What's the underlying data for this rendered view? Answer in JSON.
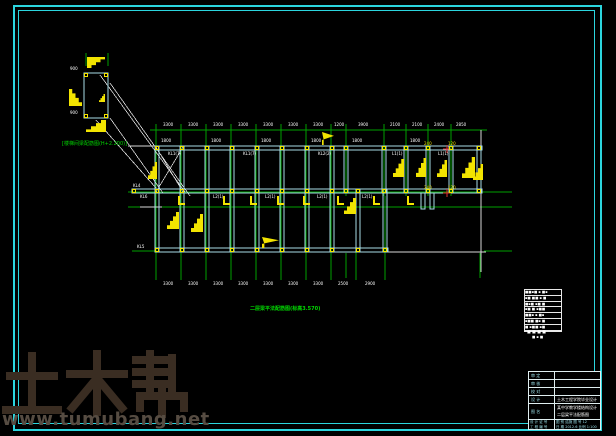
{
  "colors": {
    "background": "#000000",
    "frame": "#2bd5de",
    "grid": "#00a000",
    "beam": "#a9dde6",
    "symbol_yellow": "#f2e400",
    "line_white": "#d8d8d8",
    "accent_red": "#e03030",
    "label_green": "#00d800",
    "watermark_logo": "#3a2d22",
    "watermark_url": "#564c42"
  },
  "watermark": {
    "logo": "土木帮",
    "url": "www.tumubang.net"
  },
  "labels": {
    "detail_note": "[楼梯间梁配筋图(H+2.200)]",
    "plan_title": "二层梁平法配筋图(标高3.570)"
  },
  "legend": {
    "rows": [
      "■■▪■ ▪ ■▪",
      "▪■ ■■ ▪ ■",
      "■▪■ ▪■ ■",
      "▪■ ■ ▪■■",
      "■■▪ ▪ ■▪",
      "▪■■ ■▪ ■",
      "■ ▪■■ ▪■"
    ],
    "caption": "■ ■ ■ ■",
    "scale": "■ ▪ ■"
  },
  "title_block": {
    "rows": [
      {
        "label": "审 定",
        "value": ""
      },
      {
        "label": "审 核",
        "value": ""
      },
      {
        "label": "校 对",
        "value": ""
      },
      {
        "label": "设 计",
        "value": "土木工程学院毕业设计"
      },
      {
        "label": "图 名",
        "value": "某中学教学楼结构设计",
        "value2": "二层梁平法配筋图"
      }
    ],
    "footer": [
      {
        "left": "设 计 证 号",
        "right": "图 别  结施  图 号  12"
      },
      {
        "left": "工 程 编 号",
        "right": "日 期 2012.6  比例 1:100"
      }
    ]
  },
  "drawing": {
    "grid_vlines": [
      [
        156,
        124,
        280
      ],
      [
        181,
        124,
        280
      ],
      [
        206,
        124,
        280
      ],
      [
        231,
        124,
        280
      ],
      [
        256,
        124,
        280
      ],
      [
        281,
        124,
        280
      ],
      [
        306,
        124,
        280
      ],
      [
        331,
        124,
        280
      ],
      [
        346,
        124,
        196
      ],
      [
        384,
        124,
        196
      ],
      [
        406,
        124,
        196
      ],
      [
        428,
        124,
        196
      ],
      [
        451,
        124,
        196
      ],
      [
        356,
        196,
        280
      ],
      [
        385,
        196,
        280
      ],
      [
        346,
        253,
        278
      ],
      [
        480,
        253,
        278
      ],
      [
        86,
        53,
        66
      ],
      [
        108,
        53,
        66
      ]
    ],
    "grid_hlines": [
      [
        130,
        150,
        487
      ],
      [
        192,
        128,
        512
      ],
      [
        207,
        128,
        512
      ],
      [
        251,
        132,
        156
      ],
      [
        251,
        484,
        512
      ]
    ],
    "white_lines": [
      [
        128,
        146,
        158,
        146
      ],
      [
        386,
        252,
        486,
        252
      ],
      [
        481,
        130,
        481,
        272
      ],
      [
        100,
        75,
        185,
        192
      ],
      [
        110,
        83,
        190,
        196
      ],
      [
        110,
        118,
        163,
        193
      ],
      [
        96,
        120,
        156,
        188
      ],
      [
        156,
        147,
        183,
        192
      ],
      [
        183,
        147,
        156,
        192
      ],
      [
        140,
        207,
        162,
        207
      ]
    ],
    "beams_h": [
      [
        155,
        146,
        327
      ],
      [
        132,
        189,
        350
      ],
      [
        155,
        248,
        233
      ]
    ],
    "beams_v": [
      [
        155,
        146,
        47
      ],
      [
        180,
        146,
        47
      ],
      [
        205,
        146,
        47
      ],
      [
        230,
        146,
        47
      ],
      [
        255,
        146,
        47
      ],
      [
        280,
        146,
        47
      ],
      [
        305,
        146,
        47
      ],
      [
        330,
        146,
        47
      ],
      [
        344,
        146,
        47
      ],
      [
        382,
        146,
        47
      ],
      [
        404,
        146,
        47
      ],
      [
        426,
        146,
        47
      ],
      [
        449,
        146,
        47
      ],
      [
        477,
        146,
        47
      ],
      [
        155,
        189,
        63
      ],
      [
        180,
        189,
        63
      ],
      [
        205,
        189,
        63
      ],
      [
        230,
        189,
        63
      ],
      [
        255,
        189,
        63
      ],
      [
        280,
        189,
        63
      ],
      [
        305,
        189,
        63
      ],
      [
        330,
        189,
        63
      ],
      [
        356,
        189,
        63
      ],
      [
        383,
        189,
        63
      ],
      [
        421,
        193,
        16
      ],
      [
        430,
        193,
        16
      ]
    ],
    "detail_rect": {
      "x": 84,
      "y": 73,
      "w": 24,
      "h": 45
    },
    "node_rows": [
      {
        "y": 146,
        "xs": [
          155,
          180,
          205,
          230,
          255,
          280,
          305,
          330,
          344,
          382,
          404,
          426,
          449,
          477
        ]
      },
      {
        "y": 189,
        "xs": [
          132,
          155,
          180,
          205,
          230,
          255,
          280,
          305,
          330,
          344,
          356,
          382,
          404,
          426,
          449,
          477
        ]
      },
      {
        "y": 248,
        "xs": [
          155,
          180,
          205,
          230,
          255,
          280,
          305,
          330,
          356,
          383
        ]
      },
      {
        "y": 73,
        "xs": [
          84,
          104
        ]
      },
      {
        "y": 114,
        "xs": [
          84,
          104
        ]
      }
    ],
    "stairs": [
      [
        87,
        57,
        18,
        11,
        "tl"
      ],
      [
        69,
        89,
        13,
        17,
        "bl"
      ],
      [
        86,
        120,
        20,
        12,
        "br"
      ],
      [
        99,
        94,
        6,
        8,
        "br"
      ],
      [
        148,
        162,
        9,
        17,
        "br"
      ],
      [
        167,
        212,
        12,
        17,
        "br"
      ],
      [
        191,
        214,
        12,
        18,
        "br"
      ],
      [
        322,
        132,
        12,
        13,
        "flag"
      ],
      [
        262,
        237,
        17,
        11,
        "flag"
      ],
      [
        344,
        198,
        12,
        16,
        "br"
      ],
      [
        393,
        159,
        11,
        18,
        "br"
      ],
      [
        416,
        158,
        10,
        19,
        "br"
      ],
      [
        437,
        160,
        10,
        17,
        "br"
      ],
      [
        462,
        157,
        13,
        21,
        "br"
      ],
      [
        473,
        164,
        10,
        16,
        "br"
      ]
    ],
    "l_marks": [
      [
        178,
        196
      ],
      [
        223,
        196
      ],
      [
        250,
        196
      ],
      [
        277,
        196
      ],
      [
        303,
        196
      ],
      [
        337,
        196
      ],
      [
        373,
        196
      ],
      [
        407,
        196
      ]
    ],
    "red_crosses": [
      [
        447,
        149
      ],
      [
        447,
        193
      ]
    ],
    "tiny_labels": [
      [
        163,
        123,
        "3300",
        "w"
      ],
      [
        188,
        123,
        "3300",
        "w"
      ],
      [
        213,
        123,
        "3300",
        "w"
      ],
      [
        238,
        123,
        "3300",
        "w"
      ],
      [
        263,
        123,
        "3300",
        "w"
      ],
      [
        288,
        123,
        "3300",
        "w"
      ],
      [
        313,
        123,
        "3300",
        "w"
      ],
      [
        334,
        123,
        "1200",
        "w"
      ],
      [
        358,
        123,
        "3900",
        "w"
      ],
      [
        390,
        123,
        "2100",
        "w"
      ],
      [
        412,
        123,
        "2100",
        "w"
      ],
      [
        434,
        123,
        "2400",
        "w"
      ],
      [
        456,
        123,
        "2850",
        "w"
      ],
      [
        161,
        139,
        "1800",
        "w"
      ],
      [
        211,
        139,
        "1800",
        "w"
      ],
      [
        261,
        139,
        "1800",
        "w"
      ],
      [
        311,
        139,
        "1800",
        "w"
      ],
      [
        352,
        139,
        "1800",
        "w"
      ],
      [
        410,
        139,
        "1800",
        "w"
      ],
      [
        168,
        152,
        "KL1(7)",
        "w"
      ],
      [
        243,
        152,
        "KL1(7)",
        "w"
      ],
      [
        318,
        152,
        "KL2(2)",
        "w"
      ],
      [
        392,
        152,
        "L1(1)",
        "w"
      ],
      [
        438,
        152,
        "L1(1)",
        "w"
      ],
      [
        140,
        195,
        "KL6",
        "w"
      ],
      [
        213,
        195,
        "L2(1)",
        "w"
      ],
      [
        265,
        195,
        "L2(1)",
        "w"
      ],
      [
        317,
        195,
        "L2(1)",
        "w"
      ],
      [
        362,
        195,
        "L2(1)",
        "w"
      ],
      [
        133,
        184,
        "KL4",
        "w"
      ],
      [
        137,
        245,
        "KL5",
        "w"
      ],
      [
        163,
        282,
        "3300",
        "w"
      ],
      [
        188,
        282,
        "3300",
        "w"
      ],
      [
        213,
        282,
        "3300",
        "w"
      ],
      [
        238,
        282,
        "3300",
        "w"
      ],
      [
        263,
        282,
        "3300",
        "w"
      ],
      [
        288,
        282,
        "3300",
        "w"
      ],
      [
        313,
        282,
        "3300",
        "w"
      ],
      [
        338,
        282,
        "2500",
        "w"
      ],
      [
        365,
        282,
        "2900",
        "w"
      ],
      [
        424,
        142,
        "240",
        "y"
      ],
      [
        448,
        142,
        "120",
        "y"
      ],
      [
        424,
        186,
        "240",
        "y"
      ],
      [
        448,
        186,
        "120",
        "y"
      ],
      [
        70,
        67,
        "900",
        "w"
      ],
      [
        70,
        111,
        "900",
        "w"
      ]
    ]
  }
}
